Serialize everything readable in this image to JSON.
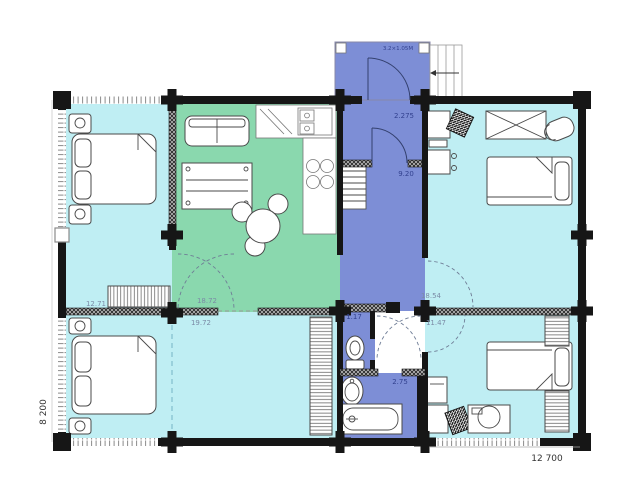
{
  "plan": {
    "dimension_width": "12 700",
    "dimension_height": "8 200",
    "colors": {
      "cyan": "#bfeef3",
      "green": "#8ad8ae",
      "blue": "#7d8ed6",
      "lobby": "#ffffff",
      "wall": "#161616"
    },
    "rooms": {
      "bedroom_top_left": {
        "area": "12.71"
      },
      "living_kitchen": {
        "area": "18.72"
      },
      "bedroom_bottom_left": {
        "area": "19.72"
      },
      "bedroom_top_right": {
        "area": "18.54"
      },
      "bedroom_bottom_right": {
        "area": "11.47"
      },
      "entry_hall": {
        "area": "2.275"
      },
      "corridor": {
        "area": "9.20"
      },
      "wc_lobby": {
        "area": "1.17"
      },
      "bathroom": {
        "area": "2.75"
      },
      "porch": {
        "label": "3.2×1.05M"
      }
    }
  }
}
